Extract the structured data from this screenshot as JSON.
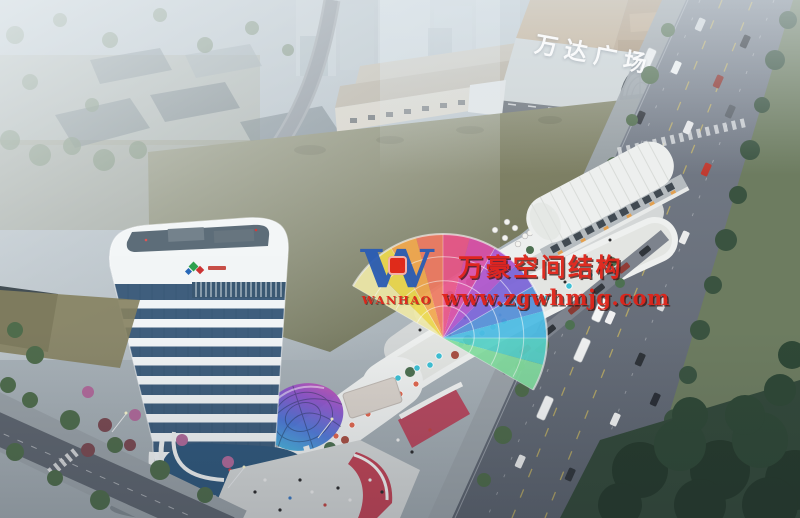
{
  "meta": {
    "type": "aerial-architectural-rendering",
    "description": "Dusk aerial rendering of a mixed-use retail plaza: white banded office tower, curved retail strip with rainbow fan canopy and iridescent glass dome, large green field, Wanda Plaza mall and tree-lined avenue"
  },
  "signs": {
    "mall_sign": "万达广场"
  },
  "watermark": {
    "logo_letter": "W",
    "logo_sub": "WANHAO",
    "line1": "万豪空间结构",
    "line2": "www.zgwhmjg.com"
  },
  "palette": {
    "wm_red": "#df2318",
    "logo_blue": "#2a5cb4",
    "sign_white": "#fbfcfd",
    "haze": "#c3ccd3",
    "field_a": "#8b8c70",
    "field_b": "#72755a",
    "road": "#6e7683",
    "sidewalk": "#9aa1a8",
    "tree_dark": "#2c4030",
    "tree_mid": "#4f6c4c",
    "tower_white": "#f2f5f6",
    "tower_glass": "#3f5e7d",
    "mall_roof": "#b49a7c",
    "dome_a": "#3cc8da",
    "dome_b": "#e055a8",
    "fan_colors": [
      "#eee8a8",
      "#ecd84e",
      "#f2a84e",
      "#ee7a62",
      "#e85588",
      "#d84fa8",
      "#ae54cc",
      "#7a64d8",
      "#5490d8",
      "#4cbce4",
      "#56d2c8",
      "#84dfa0"
    ]
  }
}
